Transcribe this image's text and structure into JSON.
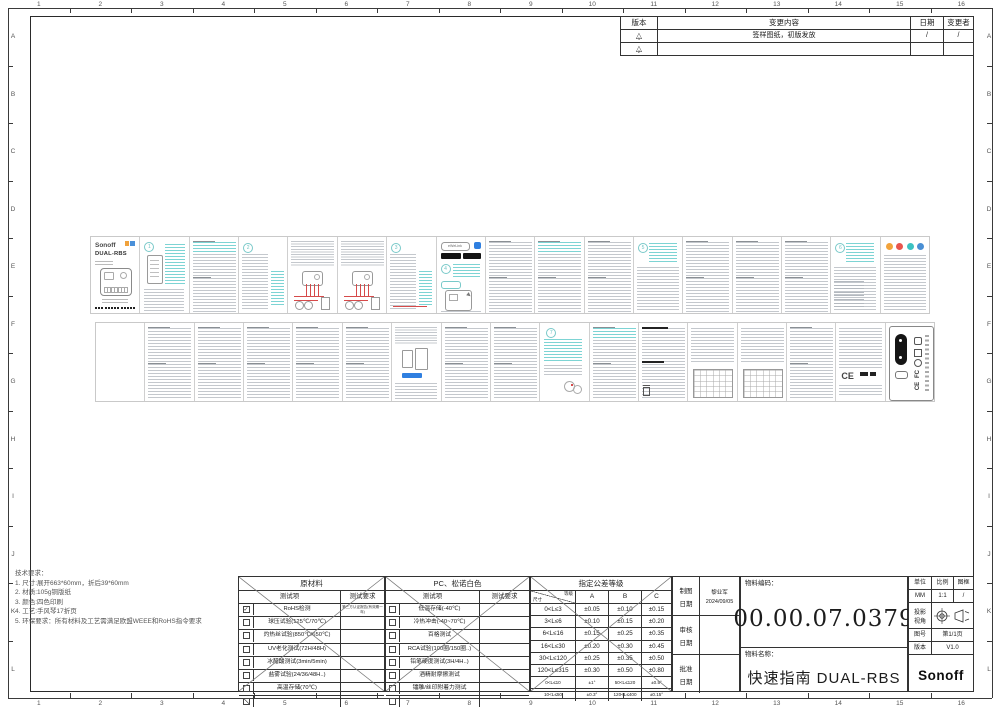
{
  "sheet": {
    "ruler": {
      "columns": [
        "1",
        "2",
        "3",
        "4",
        "5",
        "6",
        "7",
        "8",
        "9",
        "10",
        "11",
        "12",
        "13",
        "14",
        "15",
        "16"
      ],
      "rows": [
        "A",
        "B",
        "C",
        "D",
        "E",
        "F",
        "G",
        "H",
        "I",
        "J",
        "K",
        "L"
      ]
    },
    "revision_table": {
      "headers": [
        "版本",
        "变更内容",
        "日期",
        "变更者"
      ],
      "rows": [
        {
          "rev": "1",
          "content": "签样图纸，初版发放",
          "date": "/",
          "by": "/"
        },
        {
          "rev": "2",
          "content": "",
          "date": "",
          "by": ""
        }
      ]
    }
  },
  "notes": {
    "title": "技术要求：",
    "items": [
      "1.  尺寸:展开663*60mm，折后39*60mm",
      "2.  材质:105g铜版纸",
      "3.  颜色:四色印刷",
      "4.  工艺:手风琴17折页",
      "5.  环保要求：所有材料及工艺需满足欧盟WEEE和RoHS指令要求"
    ]
  },
  "tables": {
    "raw_material": {
      "title": "原材料",
      "col_item": "测试项",
      "col_req": "测试要求",
      "rows": [
        {
          "checked": true,
          "item": "RoHS检测",
          "req": "第三方认证报告(有效期一年)"
        },
        {
          "checked": false,
          "item": "球压试验(125℃/70℃)",
          "req": ""
        },
        {
          "checked": false,
          "item": "灼热丝试验(850℃/650℃)",
          "req": ""
        },
        {
          "checked": false,
          "item": "UV老化测试(72H/48H)",
          "req": ""
        },
        {
          "checked": false,
          "item": "冰醋酸测试(3min/5min)",
          "req": ""
        },
        {
          "checked": false,
          "item": "盐雾试验(24/36/48H..)",
          "req": ""
        },
        {
          "checked": false,
          "item": "高温存储(70℃)",
          "req": ""
        },
        {
          "checked": false,
          "slashed": true,
          "item": "",
          "req": ""
        }
      ]
    },
    "plastic": {
      "title": "PC、松诺白色",
      "col_item": "测试项",
      "col_req": "测试要求",
      "rows": [
        {
          "checked": false,
          "item": "低温存储(-40℃)",
          "req": ""
        },
        {
          "checked": false,
          "item": "冷热冲击(-40~70℃)",
          "req": ""
        },
        {
          "checked": false,
          "item": "百格测试",
          "req": ""
        },
        {
          "checked": false,
          "item": "RCA试验(100圈/150圈..)",
          "req": ""
        },
        {
          "checked": false,
          "item": "铅笔硬度测试(3H/4H..)",
          "req": ""
        },
        {
          "checked": false,
          "item": "酒精耐摩擦测试",
          "req": ""
        },
        {
          "checked": false,
          "item": "镭雕/丝印附着力测试",
          "req": ""
        },
        {
          "checked": false,
          "item": "",
          "req": ""
        }
      ]
    },
    "tolerance": {
      "title": "指定公差等级",
      "corner_top": "等级",
      "corner_bottom": "尺寸",
      "cols": [
        "A",
        "B",
        "C"
      ],
      "rows": [
        [
          "0<L≤3",
          "±0.05",
          "±0.10",
          "±0.15"
        ],
        [
          "3<L≤6",
          "±0.10",
          "±0.15",
          "±0.20"
        ],
        [
          "6<L≤16",
          "±0.15",
          "±0.25",
          "±0.35"
        ],
        [
          "16<L≤30",
          "±0.20",
          "±0.30",
          "±0.45"
        ],
        [
          "30<L≤120",
          "±0.25",
          "±0.35",
          "±0.50"
        ],
        [
          "120<L≤315",
          "±0.30",
          "±0.50",
          "±0.80"
        ],
        [
          "0<L≤10",
          "±1°",
          "50<L≤120",
          "±0.5°"
        ],
        [
          "10<L≤50",
          "±0.3°",
          "120<L≤400",
          "±0.15°"
        ]
      ]
    }
  },
  "title_block": {
    "fields": [
      {
        "label": "制图",
        "label2": "日期",
        "value": "黎业军",
        "value2": "2024/09/05"
      },
      {
        "label": "审核",
        "label2": "日期",
        "value": "",
        "value2": ""
      },
      {
        "label": "批准",
        "label2": "日期",
        "value": "",
        "value2": ""
      }
    ],
    "part_code_label": "物料编码：",
    "part_code": "00.00.07.0379",
    "part_name_label": "物料名称：",
    "part_name": "快速指南 DUAL-RBS",
    "unit_label": "单位",
    "unit": "MM",
    "scale_label": "比例",
    "scale": "1:1",
    "frame_label": "图框",
    "frame": "/",
    "projection_label_1": "投影",
    "projection_label_2": "视角",
    "sheet_no_label": "图号",
    "sheet_no": "第1/1页",
    "version_label": "版本",
    "version": "V1.0",
    "logo": "Sonoff"
  },
  "thumbnails": {
    "cover": {
      "brand": "Sonoff",
      "model": "DUAL-RBS"
    },
    "app": {
      "search": "eWeLink"
    },
    "marks": {
      "ce": "CE",
      "fcc": "FC"
    },
    "top_strip": [
      {
        "kind": "cover"
      },
      {
        "kind": "device",
        "num": "1"
      },
      {
        "kind": "text",
        "teal_top": true
      },
      {
        "kind": "textnum",
        "num": "2"
      },
      {
        "kind": "wiring"
      },
      {
        "kind": "wiring"
      },
      {
        "kind": "textnum",
        "num": "3",
        "wire": true
      },
      {
        "kind": "app",
        "num": "4"
      },
      {
        "kind": "text"
      },
      {
        "kind": "text",
        "teal_top": true
      },
      {
        "kind": "text"
      },
      {
        "kind": "tealnum",
        "num": "5"
      },
      {
        "kind": "text"
      },
      {
        "kind": "text"
      },
      {
        "kind": "text"
      },
      {
        "kind": "tealnum",
        "num": "6",
        "list": true
      },
      {
        "kind": "icons"
      }
    ],
    "bottom_strip": [
      {
        "kind": "blank"
      },
      {
        "kind": "text"
      },
      {
        "kind": "text"
      },
      {
        "kind": "text"
      },
      {
        "kind": "text"
      },
      {
        "kind": "text"
      },
      {
        "kind": "phones"
      },
      {
        "kind": "text"
      },
      {
        "kind": "text"
      },
      {
        "kind": "sketchnum",
        "num": "7"
      },
      {
        "kind": "text",
        "teal_top": true
      },
      {
        "kind": "fcc"
      },
      {
        "kind": "tablepanel"
      },
      {
        "kind": "tablepanel"
      },
      {
        "kind": "text"
      },
      {
        "kind": "ce"
      },
      {
        "kind": "sidelabel"
      }
    ]
  },
  "colors": {
    "accent_teal": "#35c2c2",
    "teal_light": "#7dd4d4",
    "gray_line": "#c4c8cd",
    "wire_red": "#d64a4a",
    "link_blue": "#2f7fe0",
    "badge_black": "#141414",
    "chip_orange": "#f0a23c",
    "chip_blue": "#4a90d9"
  }
}
